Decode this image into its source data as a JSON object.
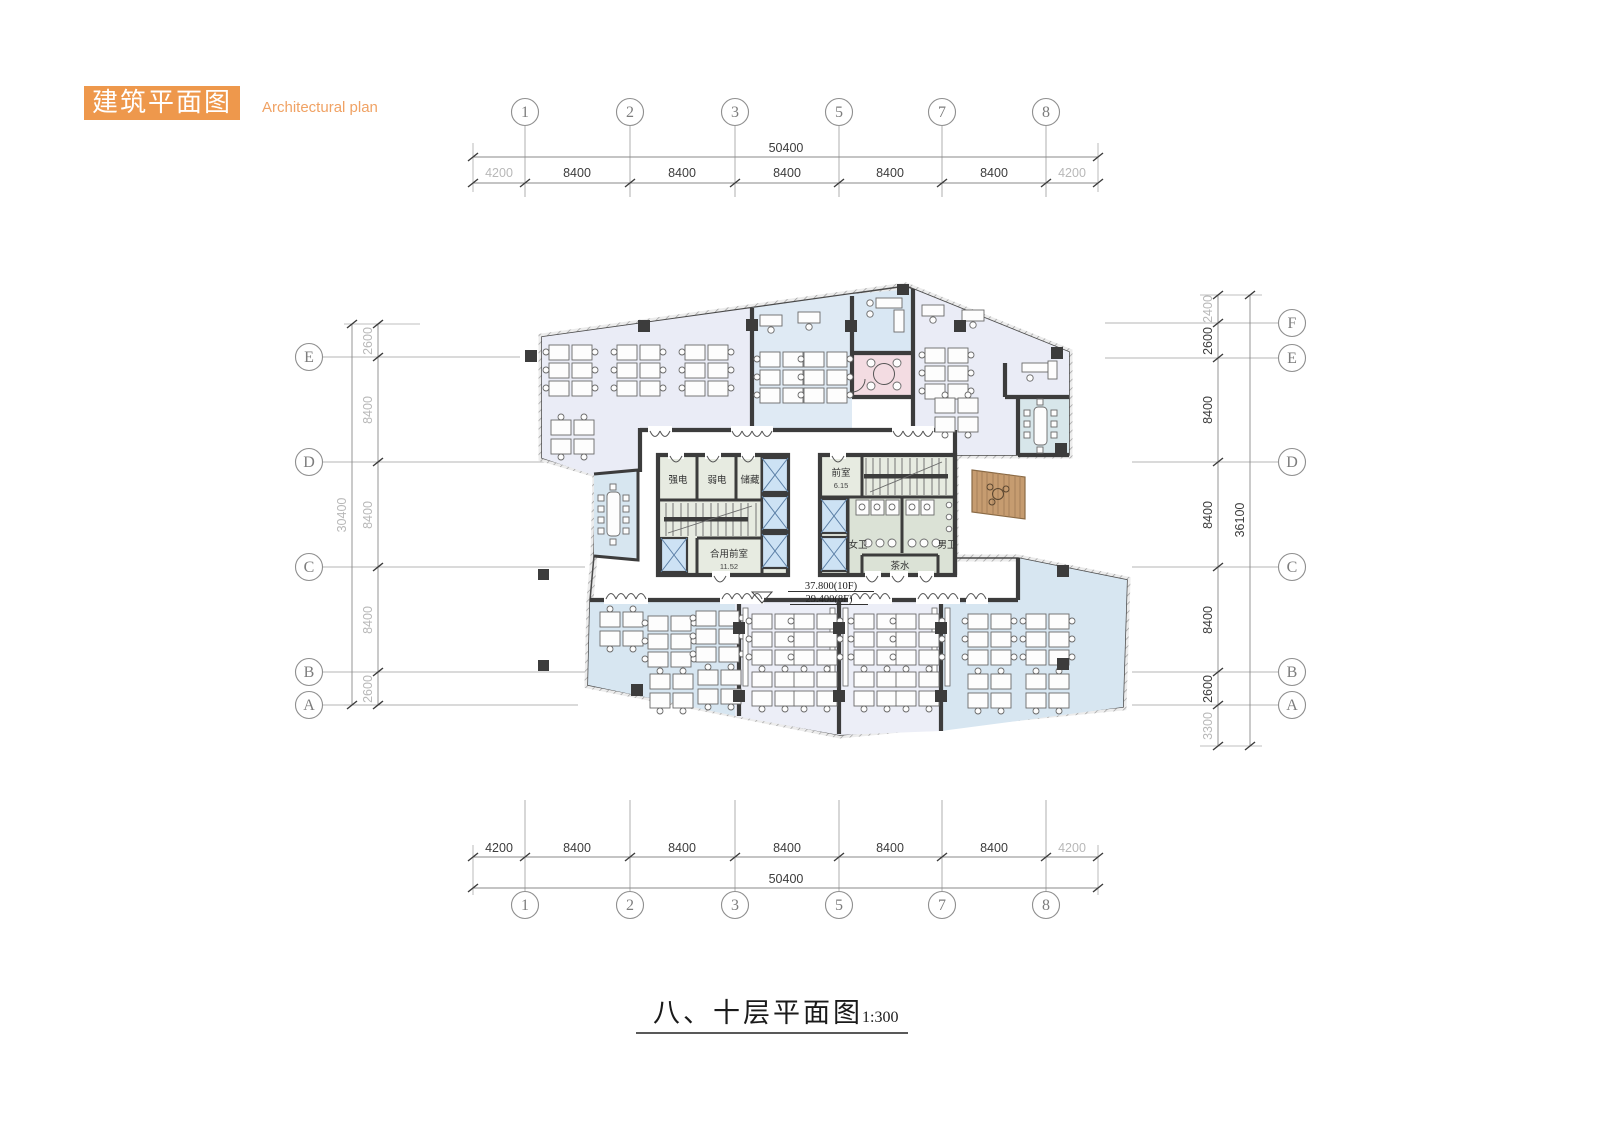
{
  "header": {
    "title_cn": "建筑平面图",
    "title_en": "Architectural plan"
  },
  "palette": {
    "accent_orange": "#ee984c",
    "wall": "#3c3c3c",
    "office_lavender": "#eaecf6",
    "office_blue": "#d7e6f1",
    "office_blue_mid": "#dfeaf4",
    "meeting_blue": "#d7e6ea",
    "pink_room": "#f3dce2",
    "core_room": "#e7ebe1",
    "toilet": "#dbe2d6",
    "elevator": "#cde2f4",
    "terrace_wood": "#c69c70",
    "grid_line": "#9c9c9c"
  },
  "grid": {
    "top_labels": [
      "1",
      "2",
      "3",
      "5",
      "7",
      "8"
    ],
    "bottom_labels": [
      "1",
      "2",
      "3",
      "5",
      "7",
      "8"
    ],
    "left_labels": [
      "E",
      "D",
      "C",
      "B",
      "A"
    ],
    "right_labels": [
      "F",
      "E",
      "D",
      "C",
      "B",
      "A"
    ],
    "top_dims": {
      "total": "50400",
      "segments": [
        "4200",
        "8400",
        "8400",
        "8400",
        "8400",
        "8400",
        "4200"
      ]
    },
    "bottom_dims": {
      "total": "50400",
      "segments": [
        "4200",
        "8400",
        "8400",
        "8400",
        "8400",
        "8400",
        "4200"
      ]
    },
    "left_dims": {
      "total": "30400",
      "segments": [
        "2600",
        "8400",
        "8400",
        "8400",
        "2600"
      ]
    },
    "right_dims": {
      "total": "36100",
      "segments": [
        "2400",
        "2600",
        "8400",
        "8400",
        "8400",
        "2600",
        "3300"
      ]
    }
  },
  "plan": {
    "rooms": {
      "strong_electric": "强电",
      "weak_electric": "弱电",
      "storage": "储藏",
      "shared_lobby": "合用前室",
      "shared_lobby_area": "11.52",
      "ante_room": "前室",
      "ante_room_area": "6.15",
      "female_wc": "女卫",
      "male_wc": "男卫",
      "pantry": "茶水"
    },
    "levels": {
      "line1": "37.800(10F)",
      "line2": "29.400(8F)"
    }
  },
  "footer": {
    "title": "八、十层平面图",
    "scale": "1:300"
  }
}
